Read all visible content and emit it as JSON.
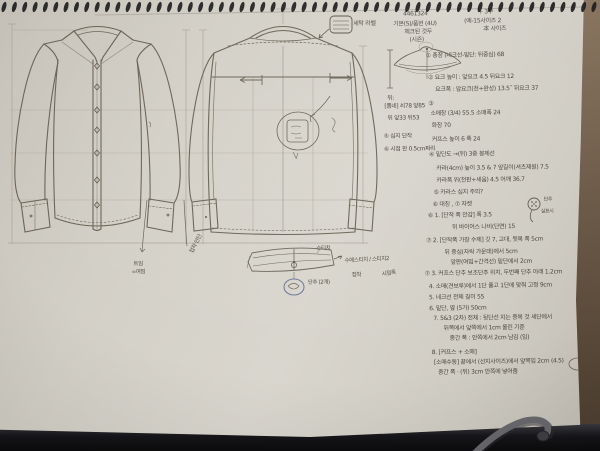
{
  "photo": {
    "paper_color": "#d6d2c9",
    "desk_color": "#6b5947",
    "pencil_color": "#6b6557",
    "ink_color": "#4b463e",
    "blue_pen_color": "#6e7b9c"
  },
  "header": {
    "style_lines": [
      "4461324",
      "기본(S)/품번 (4U)",
      "체크된 것두",
      "(시즌)"
    ],
    "size_lines": [
      "+ 3부",
      "(예-15사이즈 2",
      "本 사이즈"
    ],
    "care_label": "세탁 라벨"
  },
  "margin_notes": [
    "뒤:",
    "[폼네] 쇠78 앞85",
    "뒤 앞33 뒤53",
    "⑤ 심지 단작",
    "⑥ 시접 판 0.5cm짜리"
  ],
  "spec_notes": [
    "① 총장 (네크선-밑단: 뒤중심) 68",
    "② 요크 높이 : 앞요크 4.5  뒤요크 12",
    "요크폭 : 앞요크(천+완성) 13.5˝  뒤요크 37",
    "③",
    "소매장 (3/4) 55.5   소매폭 24",
    "화장 70",
    "커프스  높이 6   폭 24",
    "④ 밑단도 →(뒤) 3중 봉제선",
    "카라(4cm) 높이 3.5 & 7  앞길이(셔츠제원) 7.5",
    "카라폭 위(천판+세움) 4.5   어깨 36.7",
    "⑤ 카라스 심지 주의?",
    "⑥ 대칭 , ⑦ 자켓",
    "⑥ 1. [단작 폭 안감] 폭 3.5",
    "뒤  바이어스  나비(단면) 15",
    "⑦ 2. [단작폭 가장 수제] 깃 7, 고대, 뒷목 폭 5cm",
    "뒤 중심(자락 가운데)에서 5cm",
    "앞판(여밈+간격선) 밑단에서 2cm",
    "⑦ 3. 커프스 단추 보조단추 위치, 두번째 단추 아래 1.2cm",
    "4. 소매(견보루)에서 1단 풀고 1단에 맞춰 고정 9cm",
    "5. 네크선  전체 길이 55",
    "6. 밑단, 옆 (5가) 50cm",
    "7. 5&3 (2차) 전체 : 뒷단선 지는 중복 것 세단에서",
    "뒤쪽에서 앞쪽에서 1cm 올린 기준",
    "중간 폭 : 안쪽에서 2cm 남김 (임)",
    "8. [커프스 + 소매]",
    "[소매수동] 끝에서 (선지사이즈)에서 앞쪽임 2cm (4.5)",
    "중간 폭 · (뒤) 3cm 안쪽에 넣어줌"
  ],
  "sketch_labels": {
    "stitch_top": "스티치",
    "stitch_right": "수에스티치 / 스티치2",
    "adhesive": "접착",
    "seam_width": "시접폭",
    "button_pair": "단추 (2개)",
    "hem_slit_1": "트임",
    "hem_slit_2": "=여밈",
    "cuff_facing": "접착 안단",
    "button_label": "단추",
    "thread_label": "실표시"
  }
}
